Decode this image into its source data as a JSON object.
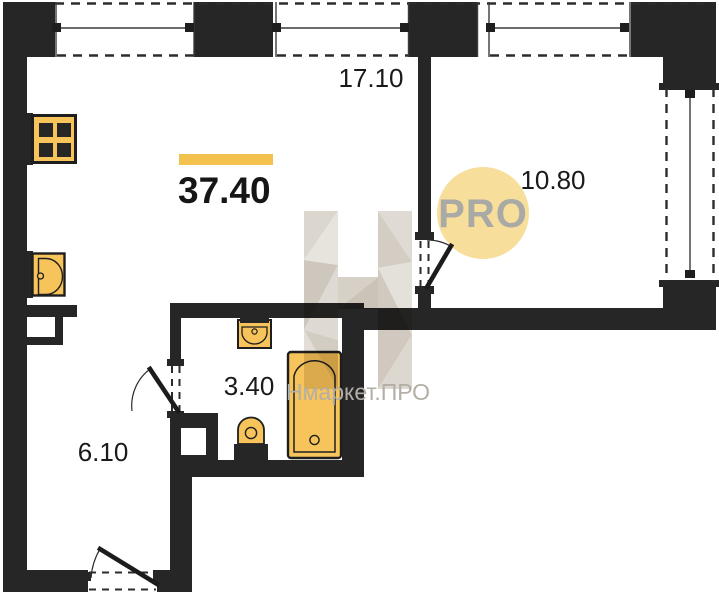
{
  "plan": {
    "total_area": "37.40",
    "rooms": [
      {
        "id": "living-room",
        "area": "17.10"
      },
      {
        "id": "bedroom",
        "area": "10.80"
      },
      {
        "id": "bathroom",
        "area": "3.40"
      },
      {
        "id": "hallway",
        "area": "6.10"
      }
    ],
    "badge": {
      "label": "PRO"
    },
    "watermark": {
      "label": "Нмаркет.ПРО"
    },
    "colors": {
      "wall": "#262626",
      "fixture_fill": "#F6C45A",
      "accent_bar": "#F2C14E",
      "badge_fill": "#F8DE9B",
      "badge_text": "#A9A9A5",
      "watermark_text": "#B3AEA6",
      "label_text": "#1A1A1A"
    },
    "icons": [
      "stove-icon",
      "kitchen-sink-icon",
      "bathroom-sink-icon",
      "toilet-icon",
      "bathtub-icon"
    ]
  }
}
